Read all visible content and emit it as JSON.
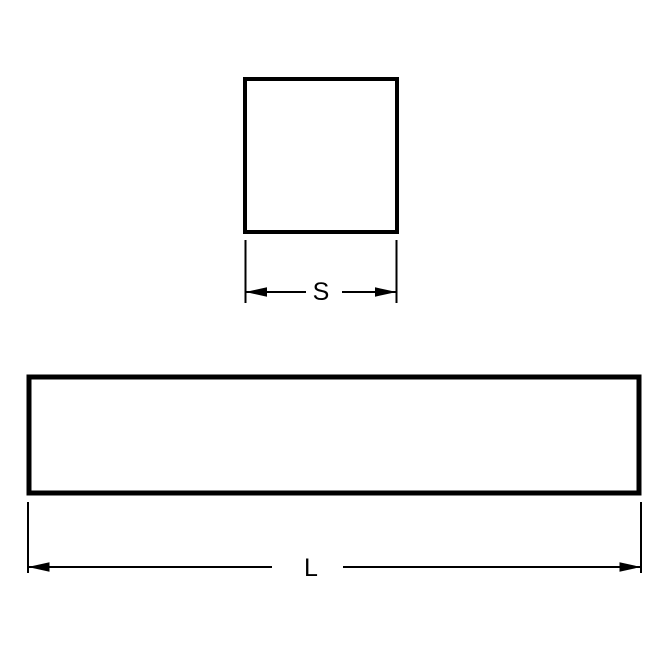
{
  "diagram": {
    "kind": "technical-drawing",
    "colors": {
      "line": "#000000",
      "background": "#ffffff"
    },
    "views": {
      "cross_section": {
        "shape": "square",
        "dimension_label": "S"
      },
      "side_view": {
        "shape": "rectangle",
        "dimension_label": "L"
      }
    }
  }
}
